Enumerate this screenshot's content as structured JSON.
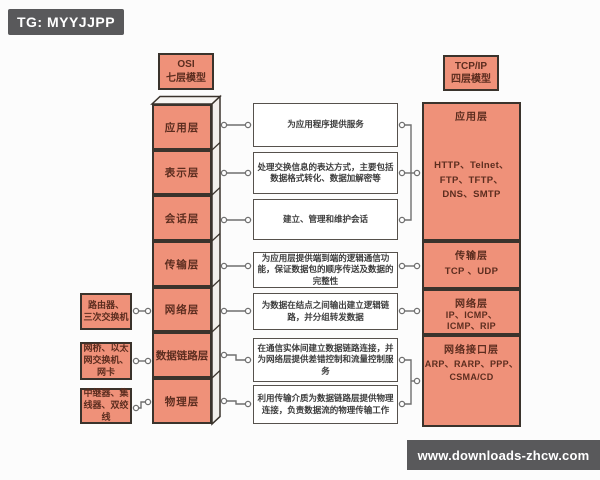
{
  "watermarks": {
    "top_left": "TG: MYYJJPP",
    "bottom_right": "www.downloads-zhcw.com"
  },
  "colors": {
    "box_fill": "#ef9179",
    "box_border": "#3a332c",
    "banner_bg": "#59595b",
    "connector": "#6f6f6f",
    "tower_side": "#f2efeb"
  },
  "osi": {
    "title": "OSI\n七层模型",
    "layers": [
      "应用层",
      "表示层",
      "会话层",
      "传输层",
      "网络层",
      "数据链路层",
      "物理层"
    ]
  },
  "descriptions": [
    "为应用程序提供服务",
    "处理交换信息的表达方式，主要包括数据格式转化、数据加解密等",
    "建立、管理和维护会话",
    "为应用层提供端到端的逻辑通信功能，保证数据包的顺序传送及数据的完整性",
    "为数据在结点之间输出建立逻辑链路，并分组转发数据",
    "在通信实体间建立数据链路连接，并为网络层提供差错控制和流量控制服务",
    "利用传输介质为数据链路层提供物理连接，负责数据流的物理传输工作"
  ],
  "devices": [
    "路由器、\n三次交换机",
    "网桥、以太\n网交换机、\n网卡",
    "中继器、集\n线器、双绞\n线"
  ],
  "tcpip": {
    "title": "TCP/IP\n四层模型",
    "layers": [
      {
        "label": "应用层",
        "protocols": "HTTP、Telnet、\nFTP、TFTP、\nDNS、SMTP"
      },
      {
        "label": "传输层",
        "protocols": "TCP 、UDP"
      },
      {
        "label": "网络层",
        "protocols": "IP、ICMP、\nICMP、RIP"
      },
      {
        "label": "网络接口层",
        "protocols": "ARP、RARP、PPP、\nCSMA/CD"
      }
    ]
  }
}
